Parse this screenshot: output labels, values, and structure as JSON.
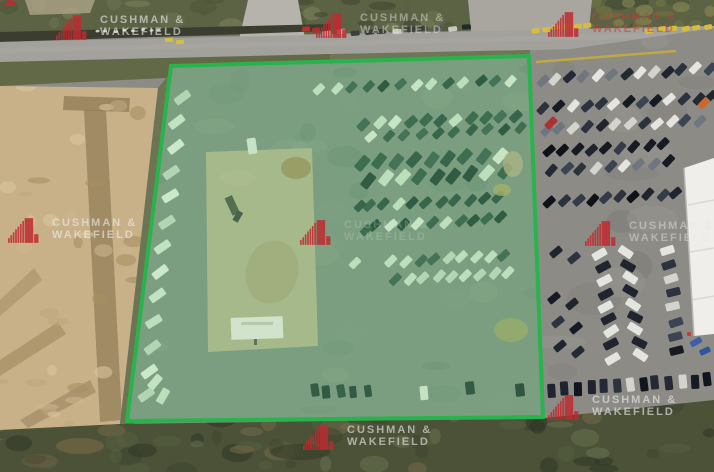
{
  "watermark": {
    "line1": "CUSHMAN &",
    "line2": "WAKEFIELD"
  },
  "colors": {
    "brand_red": "#bf2b30",
    "boundary_green": "#29b34c",
    "parcel_tint": "rgba(122,210,140,0.22)",
    "road_gray": "#a3a19b",
    "dirt_tan": "#c8b189",
    "grass_dark": "#4b5238",
    "asphalt_gray": "#8d8b86"
  }
}
